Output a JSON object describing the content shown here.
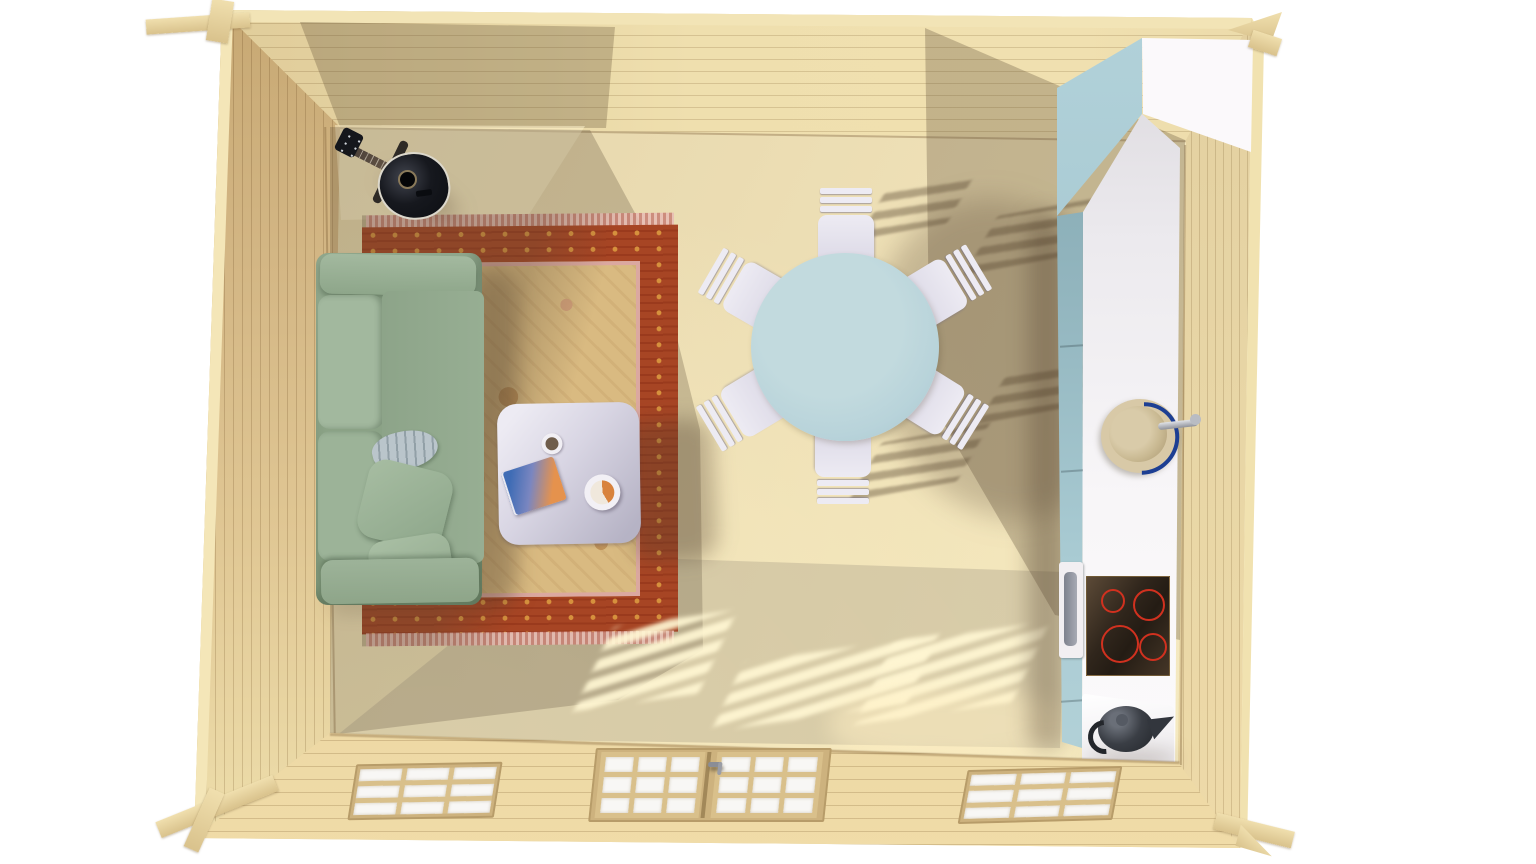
{
  "scene": {
    "description": "Top-down 3D rendering of a log cabin interior: living area with sofa, rug and coffee table, round dining table with chairs, and a kitchenette along the right wall",
    "view": "birds-eye"
  },
  "colors": {
    "wood_light": "#e7d5a2",
    "wood_wall": "#d6bb87",
    "wood_floor": "#e9dab0",
    "rug_border": "#a74524",
    "rug_gold": "#d6913d",
    "rug_field": "#d9ba81",
    "rug_fringe": "#dc9f97",
    "sofa": "#93aa8f",
    "sofa_light": "#a3b99f",
    "blanket": "#bac5cb",
    "coffee_table": "#d8d5e3",
    "book_blue": "#3f6cb5",
    "book_orange": "#e5924d",
    "bowl_orange": "#d8823c",
    "dining_table": "#b8d3da",
    "chair": "#edebf3",
    "kitchen_teal": "#a9cbd3",
    "counter": "#f6f3f5",
    "cooktop": "#30261c",
    "burner_red": "#d1311f",
    "sink_navy": "#1d3f93",
    "sink_bowl": "#d5c5a2",
    "faucet": "#c6c8ce",
    "kettle": "#33373d",
    "guitar": "#14161b",
    "pane": "#f8f7f5",
    "frame_wood": "#cdb27e"
  },
  "objects": {
    "guitar": {
      "label": "black acoustic guitar on stand"
    },
    "sofa": {
      "label": "sage green three-seat sofa",
      "pillow_count": 2,
      "has_blanket": true
    },
    "rug": {
      "label": "red and gold oriental area rug"
    },
    "coffee_table": {
      "label": "square coffee table",
      "items": [
        "mug",
        "book",
        "bowl"
      ]
    },
    "dining": {
      "label": "round pale-blue dining table",
      "chair_count": 6
    },
    "kitchen": {
      "label": "kitchenette counter along right wall",
      "appliances": [
        "tall cabinet",
        "oven",
        "sink with faucet",
        "cooktop",
        "kettle"
      ],
      "burner_count": 4
    },
    "openings": {
      "window_count": 2,
      "door": "double glazed door",
      "panes_per_sash": 9
    }
  }
}
